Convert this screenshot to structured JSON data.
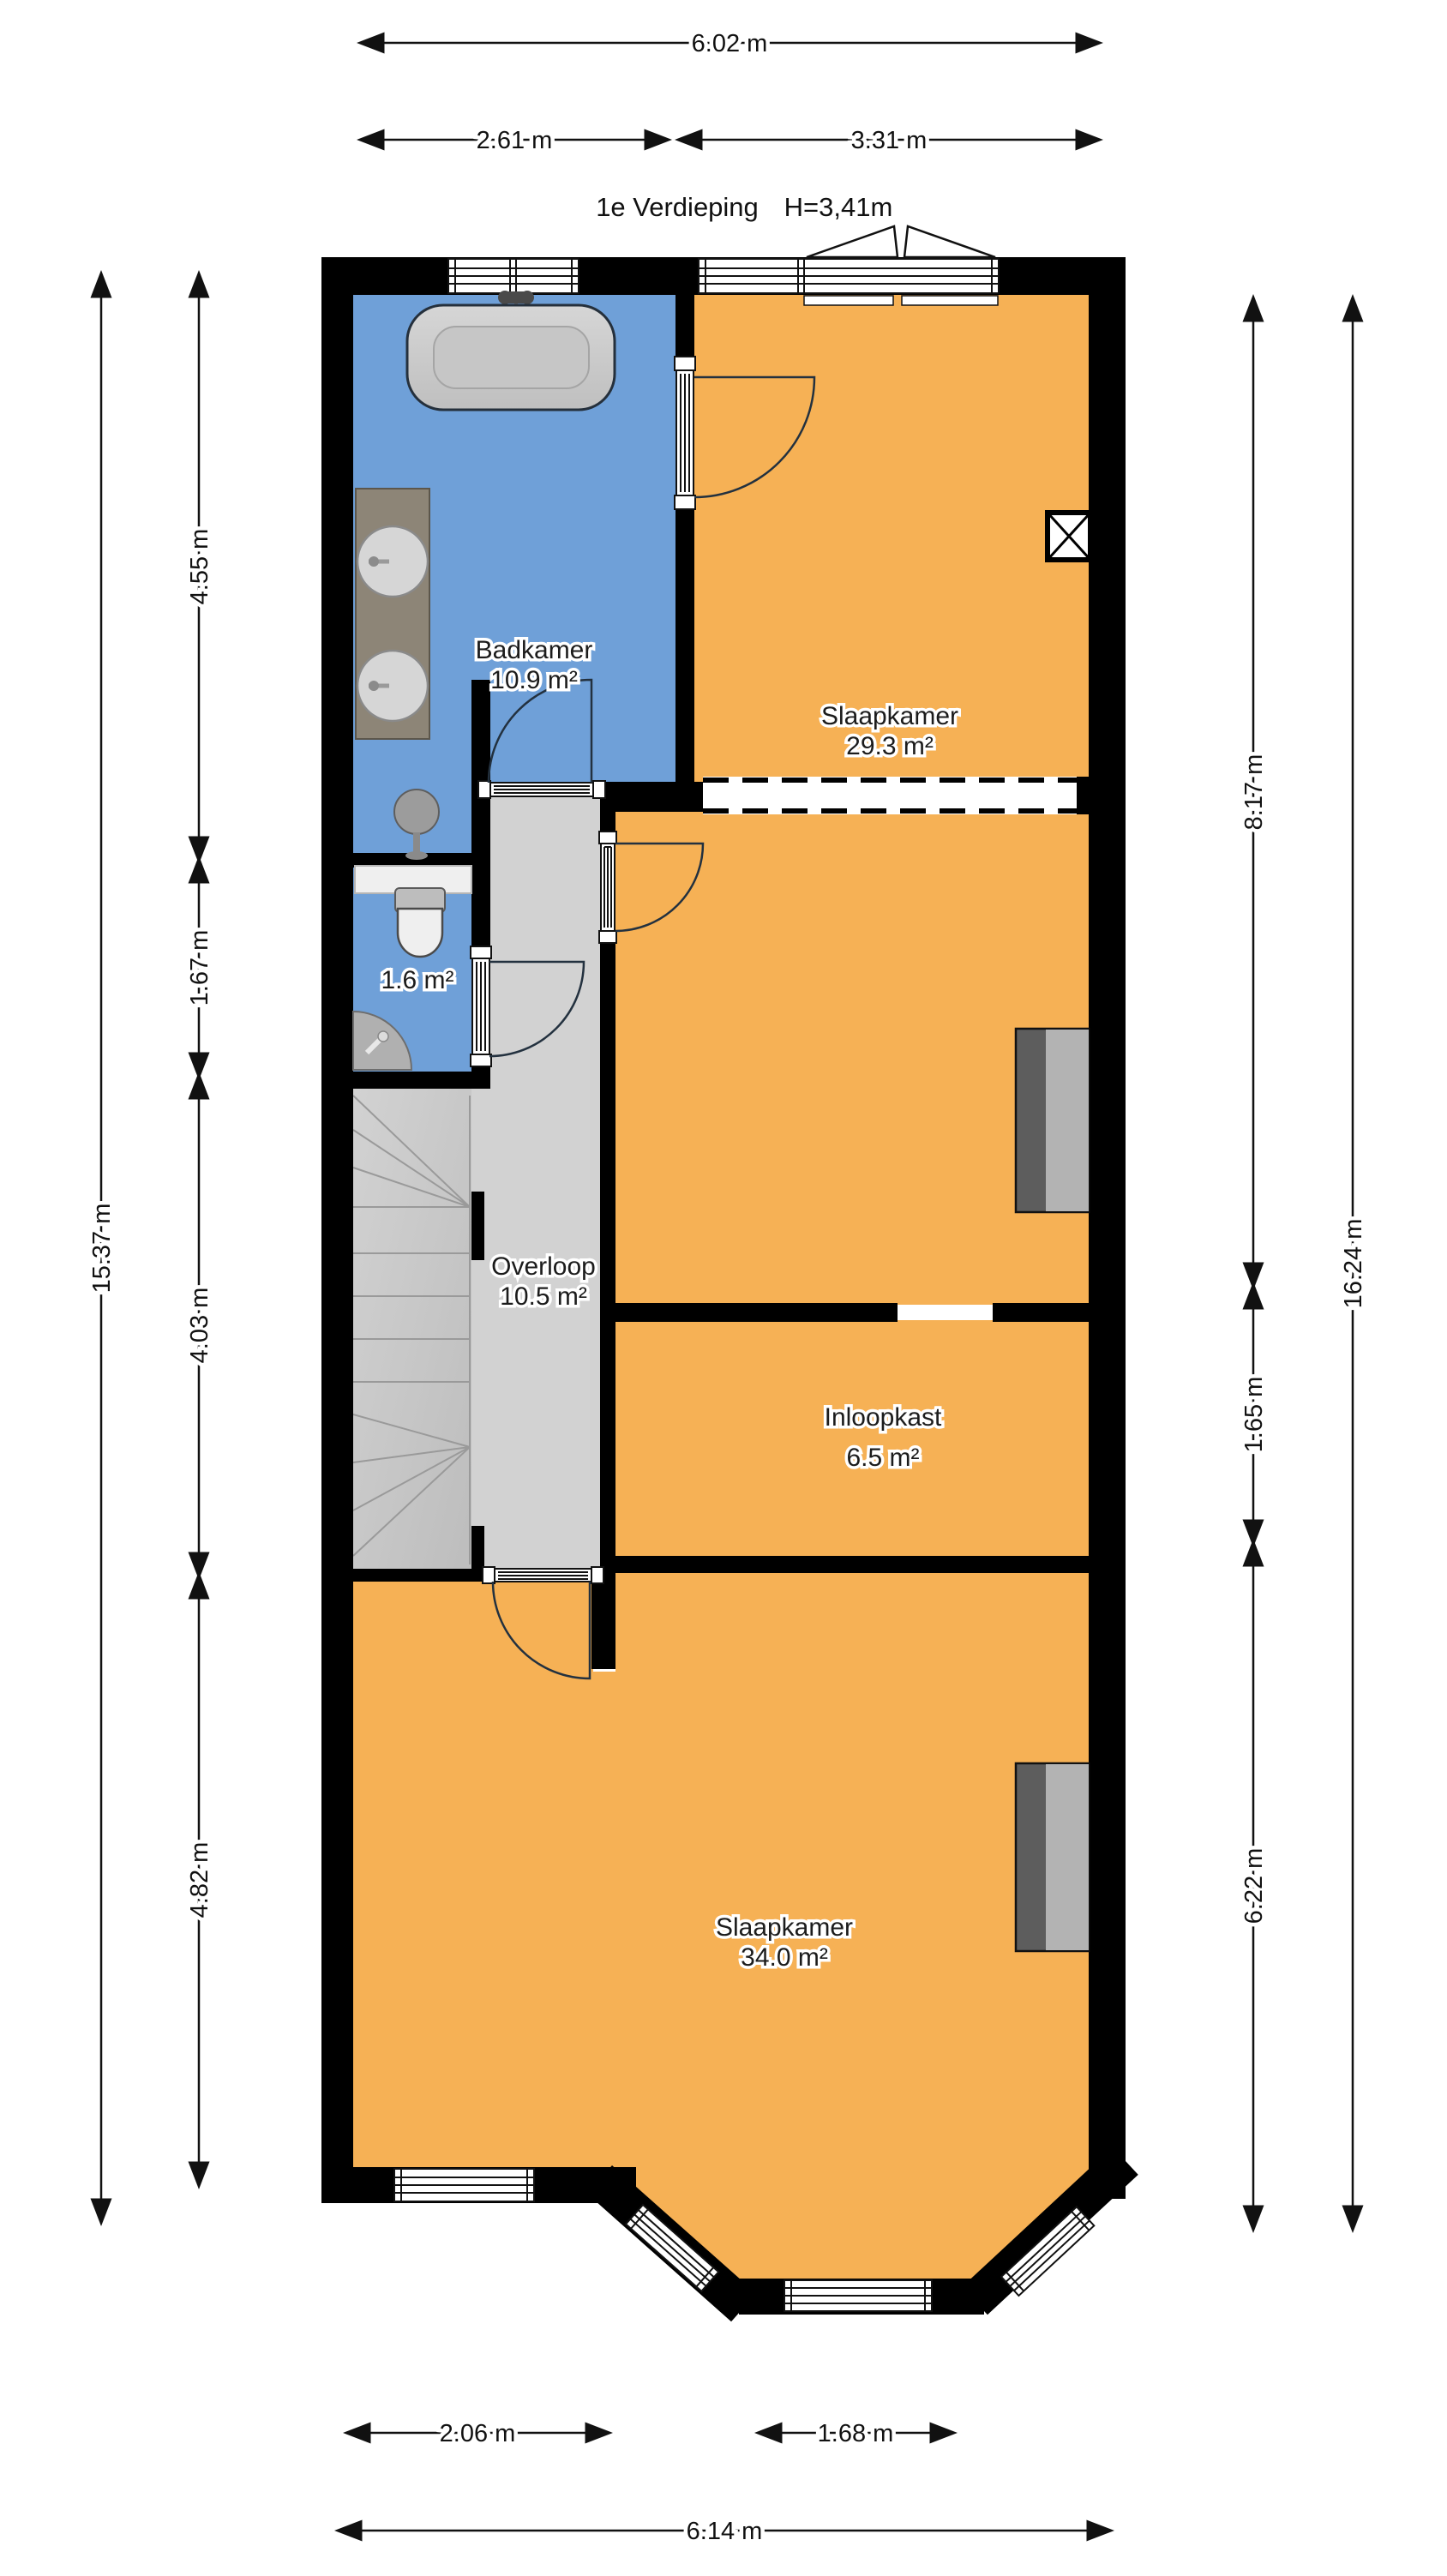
{
  "title": {
    "floor": "1e Verdieping",
    "ceiling_height": "H=3,41m"
  },
  "rooms": {
    "badkamer": {
      "name": "Badkamer",
      "area": "10.9 m²"
    },
    "toilet": {
      "area": "1.6 m²"
    },
    "overloop": {
      "name": "Overloop",
      "area": "10.5 m²"
    },
    "slaapkamer_boven": {
      "name": "Slaapkamer",
      "area": "29.3 m²"
    },
    "inloopkast": {
      "name": "Inloopkast",
      "area": "6.5 m²"
    },
    "slaapkamer_onder": {
      "name": "Slaapkamer",
      "area": "34.0 m²"
    }
  },
  "dimensions": {
    "top": {
      "total": "6.02 m",
      "left": "2.61 m",
      "right": "3.31 m"
    },
    "left": {
      "total": "15.37 m",
      "segments": [
        "4.55 m",
        "1.67 m",
        "4.03 m",
        "4.82 m"
      ]
    },
    "right": {
      "total": "16.24 m",
      "segments": [
        "8.17 m",
        "1.65 m",
        "6.22 m"
      ]
    },
    "bottom": {
      "total": "6.14 m",
      "left": "2.06 m",
      "right": "1.68 m"
    }
  },
  "colors": {
    "wall": "#000000",
    "floor_orange": "#F6B155",
    "floor_blue": "#6FA0D8",
    "hall_gray": "#D2D2D2",
    "stairs_gray": "#C9C9C9",
    "wardrobe_dark": "#5D5D5D",
    "wardrobe_light": "#B3B3B3",
    "counter_brown": "#8D8577",
    "fixture_gray": "#CCCCCC"
  }
}
